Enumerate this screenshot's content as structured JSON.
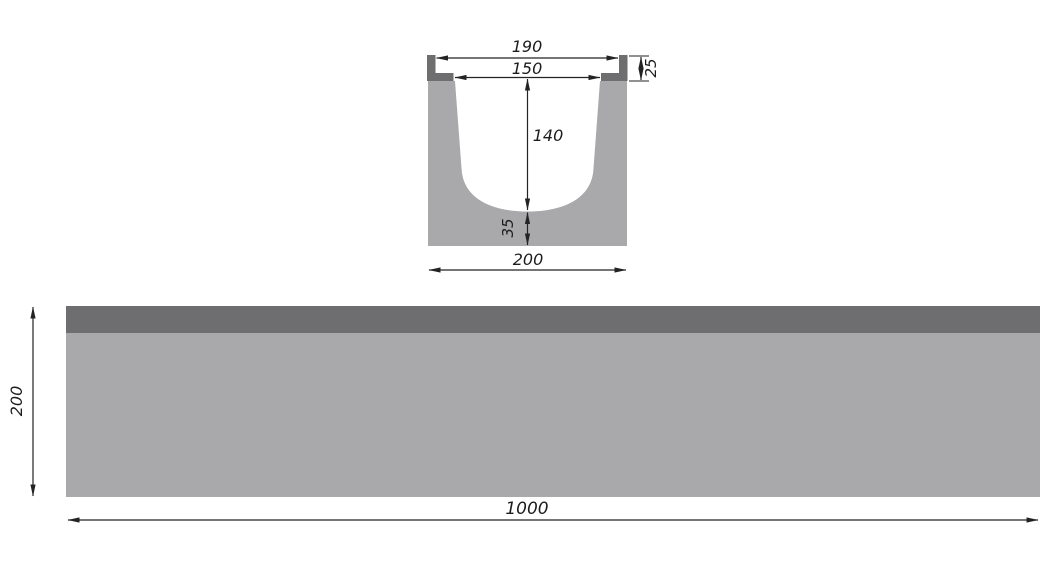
{
  "colors": {
    "body_gray": "#a9a9ab",
    "rail_dark_gray": "#6e6e70",
    "line_color": "#232323"
  },
  "cross_section": {
    "top_width": "190",
    "inner_width": "150",
    "rail_height": "25",
    "inner_depth": "140",
    "floor_thickness": "35",
    "outer_width": "200"
  },
  "side_view": {
    "height": "200",
    "length": "1000"
  }
}
